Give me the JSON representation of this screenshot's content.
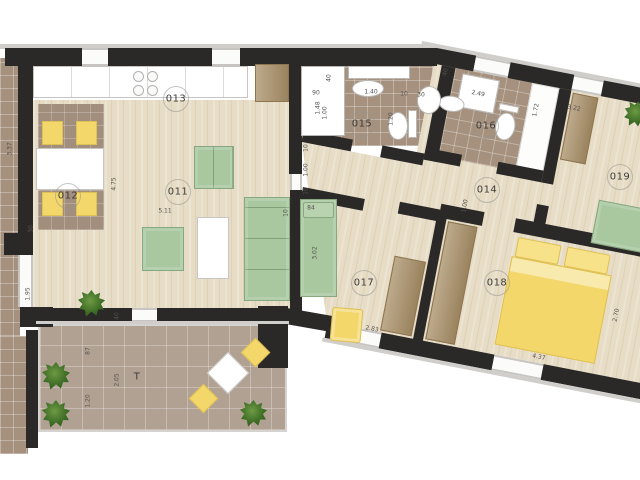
{
  "plan_title": "apartment floor plan with terrace",
  "colors": {
    "wall": "#2a2927",
    "sill": "#cfcecb",
    "wood": "#e7dcc5",
    "tile": "#a5917e",
    "terrace_tile": "#b1a193",
    "rug": "#a18e7d",
    "furniture_green": "#a9c8a0",
    "furniture_green_border": "#87a77f",
    "furniture_yellow": "#f3d76a",
    "furniture_yellow_border": "#dfc054",
    "wardrobe_brown": "#a78e66",
    "line": "#c6c5c2"
  },
  "rooms": {
    "living": "011",
    "dining": "012",
    "kitchen": "013",
    "hall": "014",
    "bath1": "015",
    "bath2": "016",
    "bedroom1": "017",
    "bedroom2": "018",
    "bedroom3": "019",
    "terrace": "T"
  },
  "labels": [
    {
      "text": "011",
      "x": 178,
      "y": 192,
      "circle": true
    },
    {
      "text": "012",
      "x": 68,
      "y": 196,
      "circle": true
    },
    {
      "text": "013",
      "x": 176,
      "y": 99,
      "circle": true
    },
    {
      "text": "014",
      "x": 487,
      "y": 190,
      "circle": true
    },
    {
      "text": "015",
      "x": 362,
      "y": 124,
      "circle": true
    },
    {
      "text": "016",
      "x": 486,
      "y": 126,
      "circle": true
    },
    {
      "text": "017",
      "x": 364,
      "y": 283,
      "circle": true
    },
    {
      "text": "018",
      "x": 497,
      "y": 283,
      "circle": true
    },
    {
      "text": "019",
      "x": 620,
      "y": 177,
      "circle": true
    },
    {
      "text": "T",
      "x": 137,
      "y": 377,
      "circle": false
    }
  ],
  "dims": [
    {
      "text": "3.37",
      "x": 10,
      "y": 149,
      "rot": -90
    },
    {
      "text": "30",
      "x": 31,
      "y": 229,
      "rot": -90
    },
    {
      "text": "1.95",
      "x": 28,
      "y": 294,
      "rot": -90
    },
    {
      "text": "4.75",
      "x": 114,
      "y": 184,
      "rot": -90
    },
    {
      "text": "5.11",
      "x": 165,
      "y": 211,
      "rot": 0
    },
    {
      "text": "10",
      "x": 286,
      "y": 213,
      "rot": -90
    },
    {
      "text": "40",
      "x": 117,
      "y": 316,
      "rot": -90
    },
    {
      "text": "87",
      "x": 88,
      "y": 351,
      "rot": -90
    },
    {
      "text": "2.05",
      "x": 117,
      "y": 380,
      "rot": -90
    },
    {
      "text": "1.20",
      "x": 88,
      "y": 401,
      "rot": -90
    },
    {
      "text": "40",
      "x": 329,
      "y": 78,
      "rot": -90
    },
    {
      "text": "90",
      "x": 316,
      "y": 93,
      "rot": 0
    },
    {
      "text": "1.40",
      "x": 371,
      "y": 92,
      "rot": 0
    },
    {
      "text": "10",
      "x": 404,
      "y": 94,
      "rot": 0
    },
    {
      "text": "30",
      "x": 421,
      "y": 95,
      "rot": 0
    },
    {
      "text": "1.48",
      "x": 318,
      "y": 108,
      "rot": -90
    },
    {
      "text": "1.00",
      "x": 325,
      "y": 113,
      "rot": -90
    },
    {
      "text": "1.20",
      "x": 391,
      "y": 119,
      "rot": -90
    },
    {
      "text": "10",
      "x": 306,
      "y": 148,
      "rot": -90
    },
    {
      "text": "1.00",
      "x": 306,
      "y": 170,
      "rot": -90
    },
    {
      "text": "10",
      "x": 306,
      "y": 191,
      "rot": -90
    },
    {
      "text": "1.00",
      "x": 465,
      "y": 206,
      "rot": -79
    },
    {
      "text": "84",
      "x": 311,
      "y": 208,
      "rot": 0
    },
    {
      "text": "3.02",
      "x": 315,
      "y": 253,
      "rot": -90
    },
    {
      "text": "2.83",
      "x": 372,
      "y": 329,
      "rot": 11
    }
  ],
  "wing_dims": [
    {
      "text": "40",
      "x": 153,
      "y": 22,
      "rot": -90
    },
    {
      "text": "2.49",
      "x": 189,
      "y": 37,
      "rot": 0
    },
    {
      "text": "1.72",
      "x": 249,
      "y": 42,
      "rot": -90
    },
    {
      "text": "3.22",
      "x": 286,
      "y": 33,
      "rot": 0
    },
    {
      "text": "2.70",
      "x": 367,
      "y": 228,
      "rot": -90
    },
    {
      "text": "4.37",
      "x": 299,
      "y": 284,
      "rot": 0
    }
  ],
  "trees": [
    {
      "x": 78,
      "y": 290,
      "s": 27
    },
    {
      "x": 42,
      "y": 362,
      "s": 28
    },
    {
      "x": 42,
      "y": 400,
      "s": 28
    },
    {
      "x": 240,
      "y": 400,
      "s": 27
    }
  ]
}
